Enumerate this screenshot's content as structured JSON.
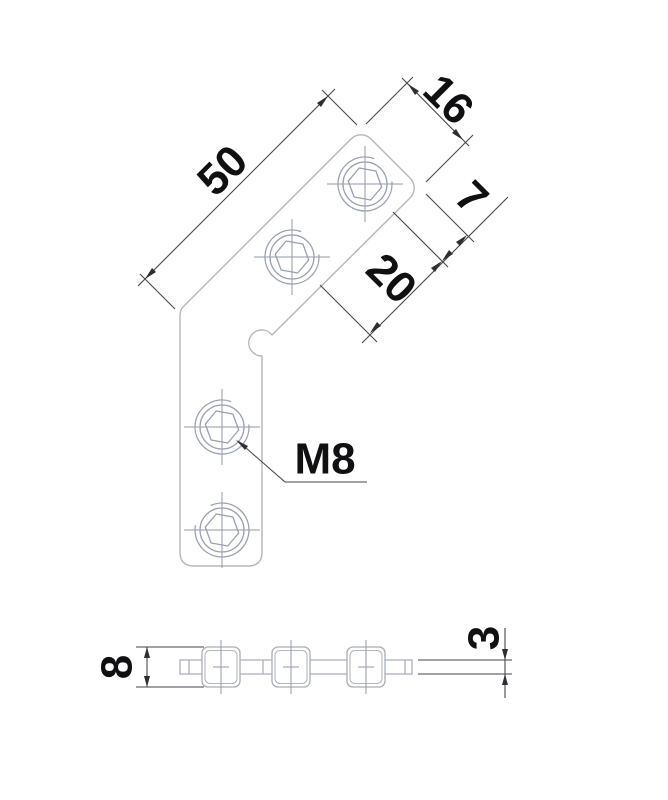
{
  "drawing": {
    "type": "technical-dimension-drawing",
    "part": "angle-bracket with hex-socket holes",
    "colors": {
      "background": "#ffffff",
      "part_outline": "#b3b6bd",
      "hole_geometry": "#9aa1b0",
      "centerline": "#939aa9",
      "dimension_line": "#46464c",
      "dimension_text": "#101012"
    },
    "main_view": {
      "dims": {
        "edge_length": "50",
        "arm_width": "16",
        "end_to_hole": "7",
        "hole_pitch": "20"
      },
      "thread_label": "M8"
    },
    "side_view": {
      "dims": {
        "overall_height": "8",
        "plate_thickness": "3"
      }
    }
  }
}
